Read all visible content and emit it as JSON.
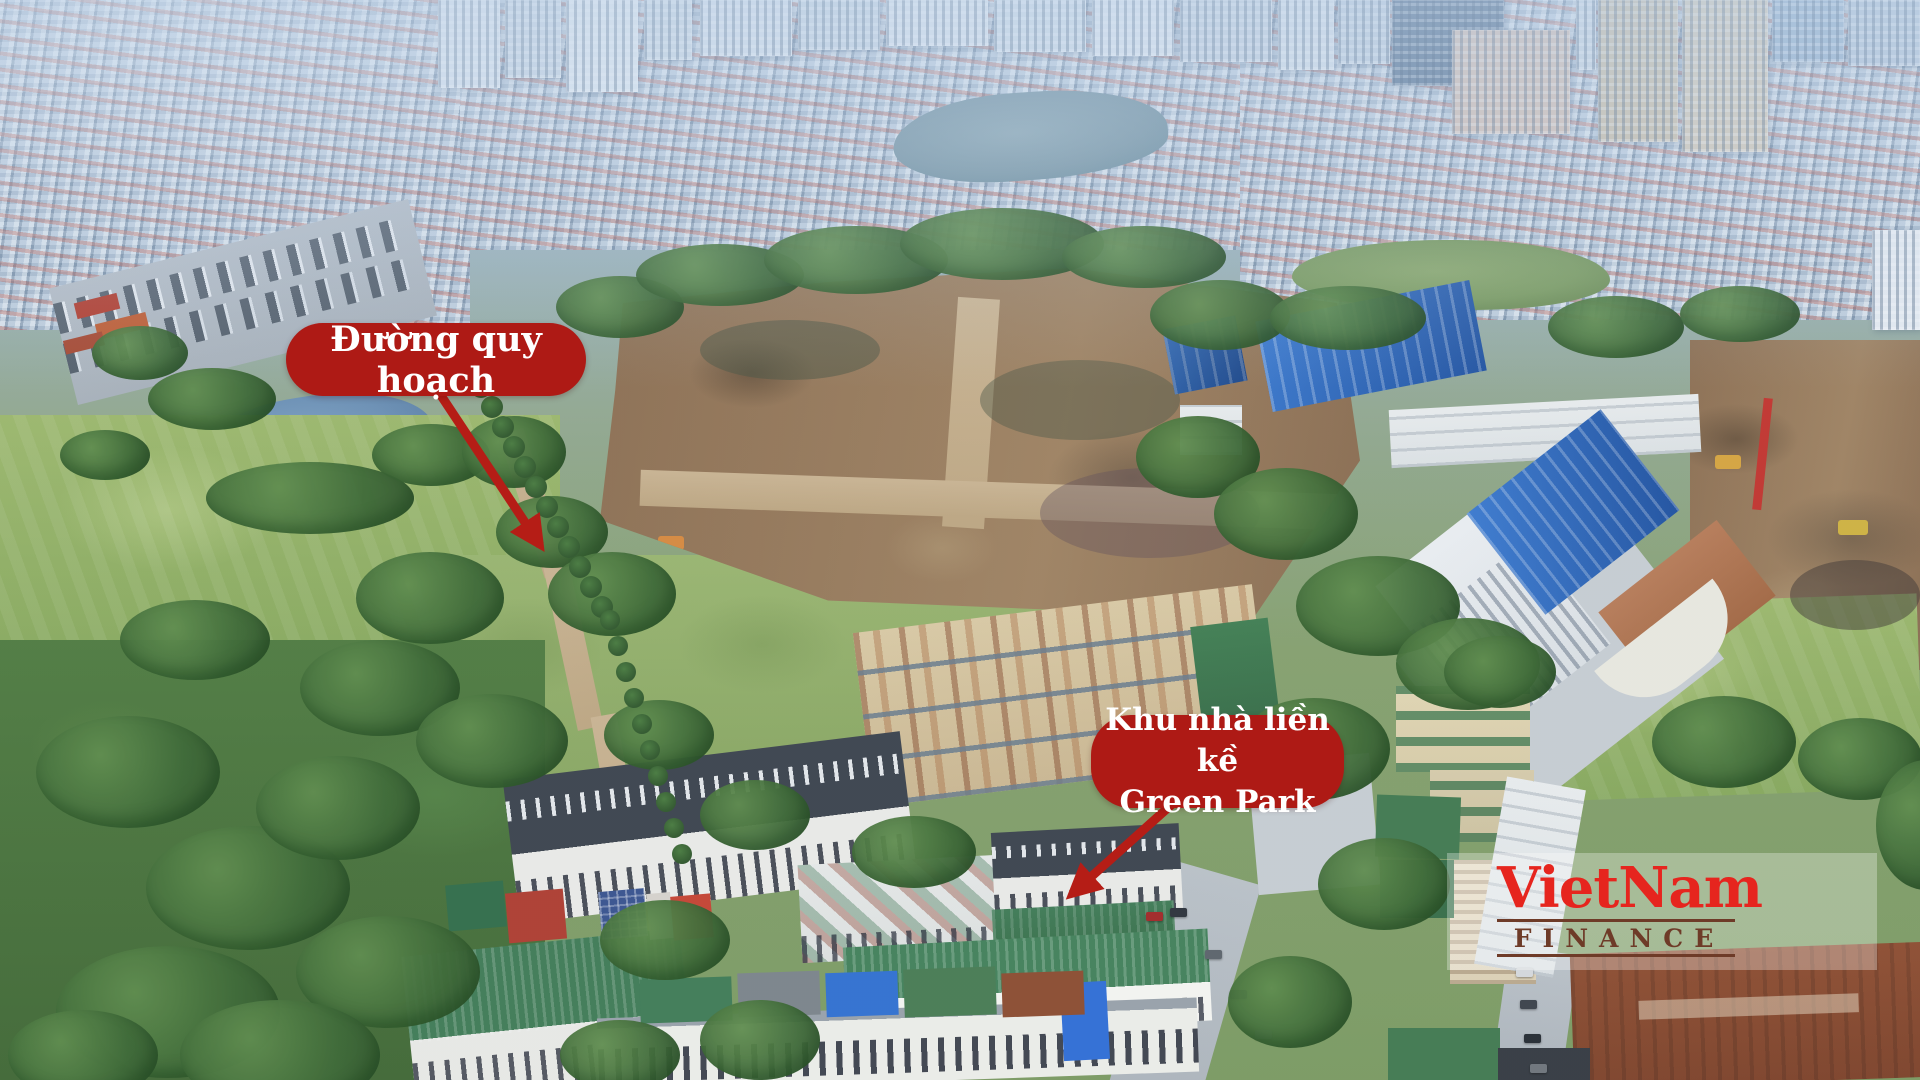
{
  "annotations": {
    "callout_road": {
      "label": "Đường quy hoạch"
    },
    "callout_greenpark": {
      "label_line1": "Khu nhà liền kề",
      "label_line2": "Green Park"
    },
    "pill_color": "#ae1a15",
    "label_text_color": "#ffffff",
    "arrow_color": "#b51d16"
  },
  "watermark": {
    "brand_primary": "VietNam",
    "brand_secondary": "FINANCE",
    "primary_color": "#e6251e",
    "secondary_color": "#6e3b28"
  }
}
